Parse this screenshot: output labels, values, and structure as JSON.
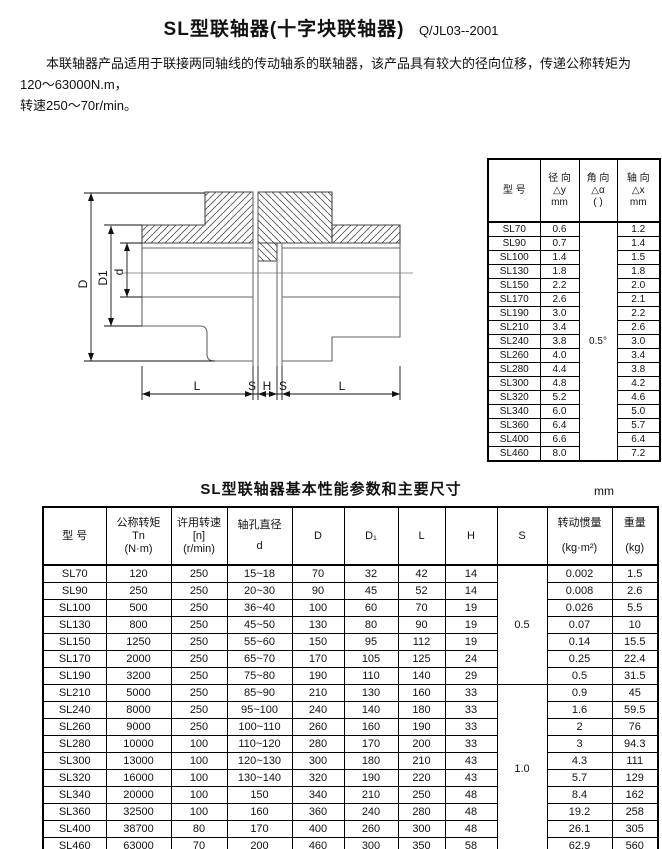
{
  "header": {
    "title": "SL型联轴器(十字块联轴器)",
    "code": "Q/JL03--2001"
  },
  "intro": {
    "line1": "本联轴器产品适用于联接两同轴线的传动轴系的联轴器，该产品具有较大的径向位移，传递公称转矩为120～63000N.m，",
    "line2": "转速250～70r/min。"
  },
  "drawing": {
    "labels": {
      "D": "D",
      "D1": "D1",
      "d": "d",
      "L": "L",
      "S": "S",
      "H": "H"
    }
  },
  "mis_table": {
    "headers": {
      "model": "型  号",
      "radial": [
        "径  向",
        "△y",
        "mm"
      ],
      "angular": [
        "角  向",
        "△α",
        "( )"
      ],
      "axial": [
        "轴  向",
        "△x",
        "mm"
      ]
    },
    "angular_value": "0.5°",
    "rows": [
      [
        "SL70",
        "0.6",
        "1.2"
      ],
      [
        "SL90",
        "0.7",
        "1.4"
      ],
      [
        "SL100",
        "1.4",
        "1.5"
      ],
      [
        "SL130",
        "1.8",
        "1.8"
      ],
      [
        "SL150",
        "2.2",
        "2.0"
      ],
      [
        "SL170",
        "2.6",
        "2.1"
      ],
      [
        "SL190",
        "3.0",
        "2.2"
      ],
      [
        "SL210",
        "3.4",
        "2.6"
      ],
      [
        "SL240",
        "3.8",
        "3.0"
      ],
      [
        "SL260",
        "4.0",
        "3.4"
      ],
      [
        "SL280",
        "4.4",
        "3.8"
      ],
      [
        "SL300",
        "4.8",
        "4.2"
      ],
      [
        "SL320",
        "5.2",
        "4.6"
      ],
      [
        "SL340",
        "6.0",
        "5.0"
      ],
      [
        "SL360",
        "6.4",
        "5.7"
      ],
      [
        "SL400",
        "6.6",
        "6.4"
      ],
      [
        "SL460",
        "8.0",
        "7.2"
      ]
    ]
  },
  "spec_table": {
    "title": "SL型联轴器基本性能参数和主要尺寸",
    "unit": "mm",
    "headers": {
      "model": "型  号",
      "torque": [
        "公称转矩",
        "Tn",
        "(N·m)"
      ],
      "speed": [
        "许用转速",
        "[n]",
        "(r/min)"
      ],
      "bore": [
        "轴孔直径",
        "d"
      ],
      "D": "D",
      "D1": "D₁",
      "L": "L",
      "H": "H",
      "S": "S",
      "inertia": [
        "转动惯量",
        "(kg·m²)"
      ],
      "weight": [
        "重量",
        "(kg)"
      ]
    },
    "s_groups": [
      {
        "value": "0.5"
      },
      {
        "value": "1.0"
      }
    ],
    "rows": [
      [
        "SL70",
        "120",
        "250",
        "15~18",
        "70",
        "32",
        "42",
        "14",
        "0.002",
        "1.5"
      ],
      [
        "SL90",
        "250",
        "250",
        "20~30",
        "90",
        "45",
        "52",
        "14",
        "0.008",
        "2.6"
      ],
      [
        "SL100",
        "500",
        "250",
        "36~40",
        "100",
        "60",
        "70",
        "19",
        "0.026",
        "5.5"
      ],
      [
        "SL130",
        "800",
        "250",
        "45~50",
        "130",
        "80",
        "90",
        "19",
        "0.07",
        "10"
      ],
      [
        "SL150",
        "1250",
        "250",
        "55~60",
        "150",
        "95",
        "112",
        "19",
        "0.14",
        "15.5"
      ],
      [
        "SL170",
        "2000",
        "250",
        "65~70",
        "170",
        "105",
        "125",
        "24",
        "0.25",
        "22.4"
      ],
      [
        "SL190",
        "3200",
        "250",
        "75~80",
        "190",
        "110",
        "140",
        "29",
        "0.5",
        "31.5"
      ],
      [
        "SL210",
        "5000",
        "250",
        "85~90",
        "210",
        "130",
        "160",
        "33",
        "0.9",
        "45"
      ],
      [
        "SL240",
        "8000",
        "250",
        "95~100",
        "240",
        "140",
        "180",
        "33",
        "1.6",
        "59.5"
      ],
      [
        "SL260",
        "9000",
        "250",
        "100~110",
        "260",
        "160",
        "190",
        "33",
        "2",
        "76"
      ],
      [
        "SL280",
        "10000",
        "100",
        "110~120",
        "280",
        "170",
        "200",
        "33",
        "3",
        "94.3"
      ],
      [
        "SL300",
        "13000",
        "100",
        "120~130",
        "300",
        "180",
        "210",
        "43",
        "4.3",
        "111"
      ],
      [
        "SL320",
        "16000",
        "100",
        "130~140",
        "320",
        "190",
        "220",
        "43",
        "5.7",
        "129"
      ],
      [
        "SL340",
        "20000",
        "100",
        "150",
        "340",
        "210",
        "250",
        "48",
        "8.4",
        "162"
      ],
      [
        "SL360",
        "32500",
        "100",
        "160",
        "360",
        "240",
        "280",
        "48",
        "19.2",
        "258"
      ],
      [
        "SL400",
        "38700",
        "80",
        "170",
        "400",
        "260",
        "300",
        "48",
        "26.1",
        "305"
      ],
      [
        "SL460",
        "63000",
        "70",
        "200",
        "460",
        "300",
        "350",
        "58",
        "62.9",
        "560"
      ]
    ]
  }
}
